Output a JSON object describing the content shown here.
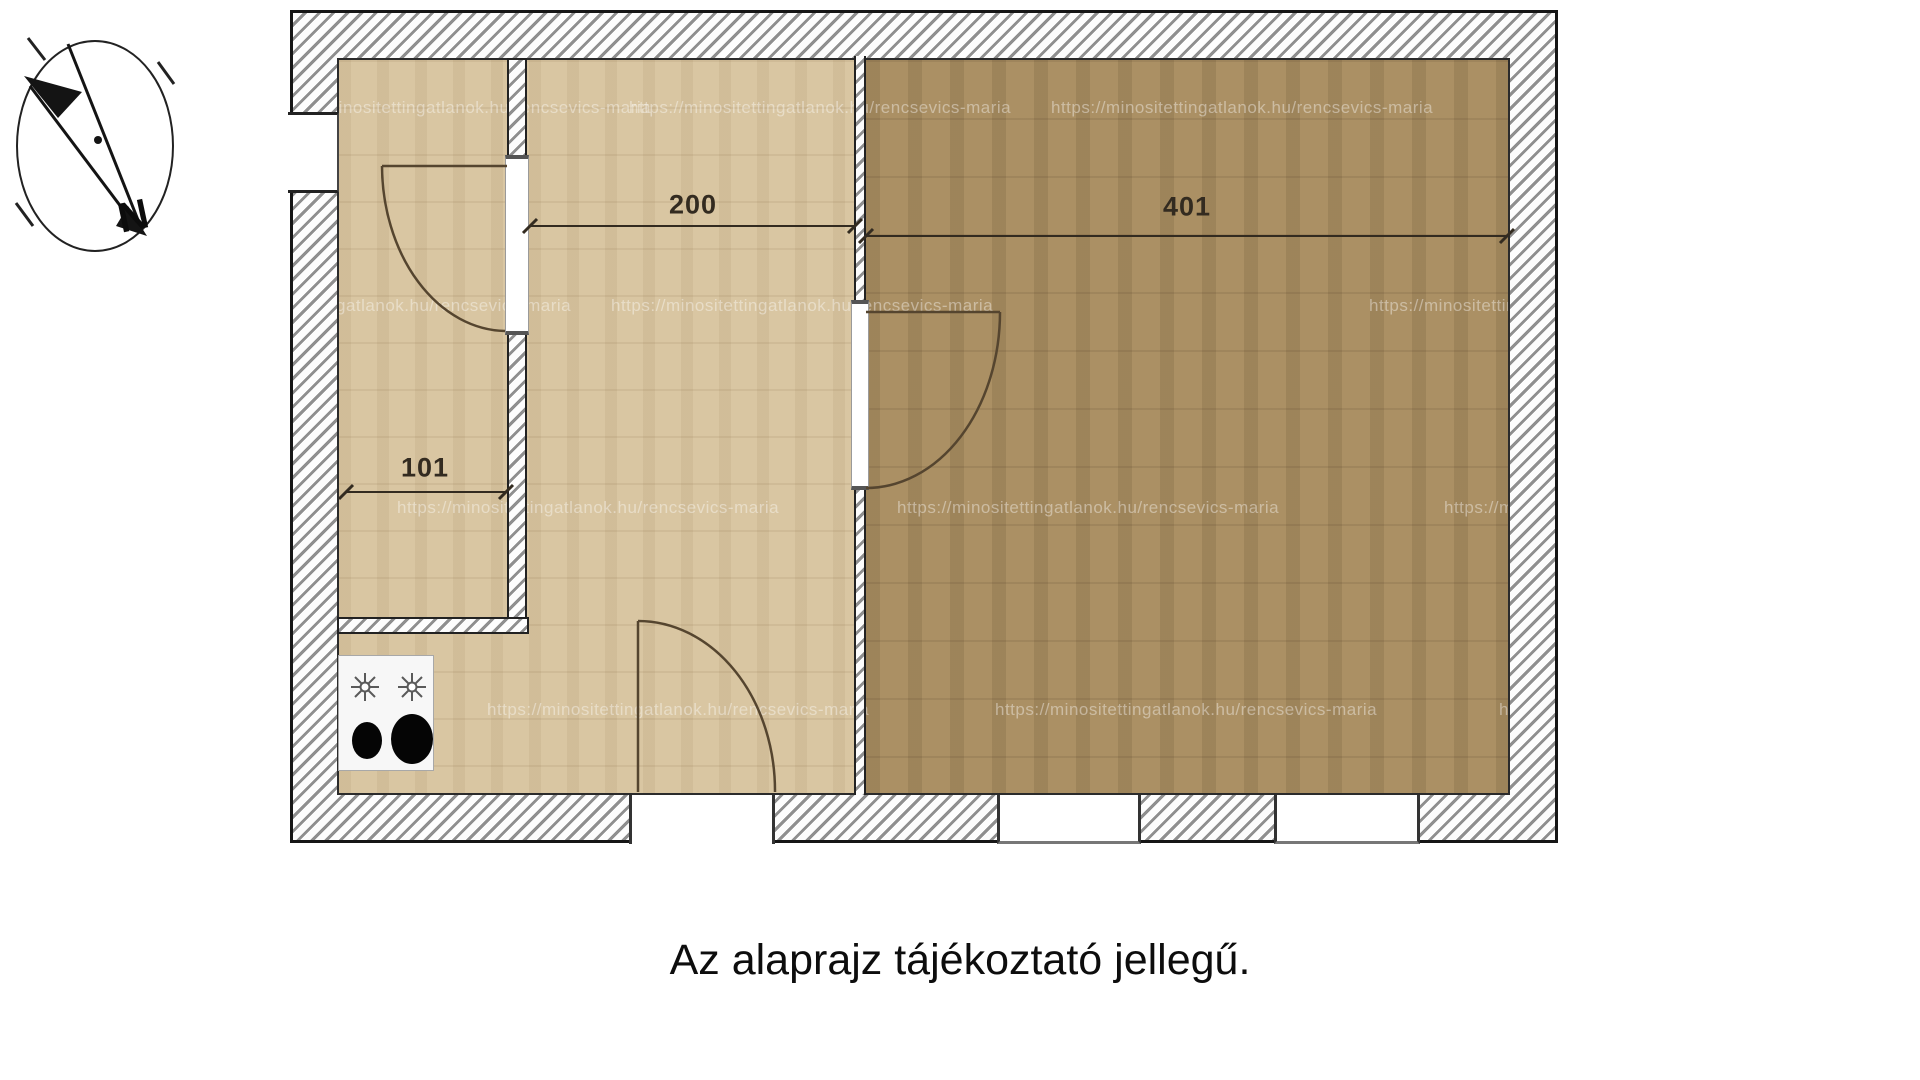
{
  "plan": {
    "caption": "Az alaprajz tájékoztató jellegű.",
    "watermark": "https://minositettingatlanok.hu/rencsevics-maria",
    "compass": {
      "north_label": "N"
    },
    "dimensions": {
      "hall_width": "101",
      "left_room_width": "200",
      "right_room_width": "401"
    },
    "colors": {
      "left_room_floor": "#d9c6a2",
      "right_room_floor": "#ab9064",
      "wall_fill": "#fdfdfd",
      "wall_hatch_line": "#8f8f8f",
      "wall_outline": "#222222",
      "dimension_text": "#332b20",
      "page_background": "#ffffff"
    }
  }
}
